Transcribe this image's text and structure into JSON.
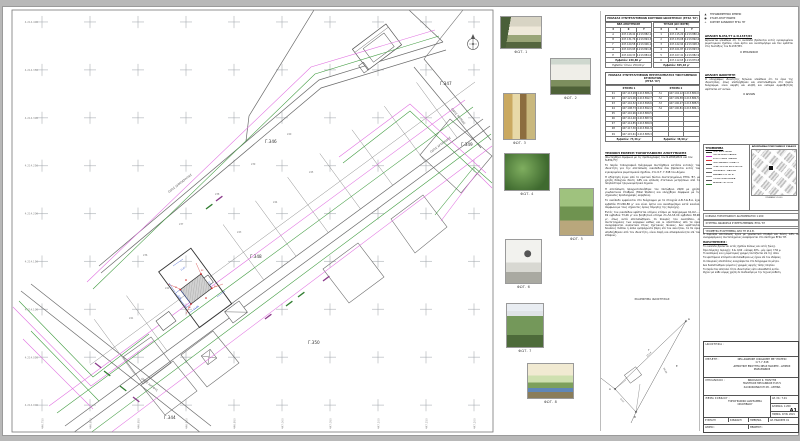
{
  "plan": {
    "northings": [
      "4.214.400",
      "4.214.350",
      "4.214.300",
      "4.214.250",
      "4.214.200",
      "4.214.150",
      "4.214.100",
      "4.214.050",
      "4.214.000"
    ],
    "eastings": [
      "446.750",
      "446.800",
      "446.850",
      "446.900",
      "446.950",
      "447.000",
      "447.050",
      "447.100",
      "447.150",
      "447.200"
    ],
    "blocks": {
      "g344": "Γ.344",
      "g346": "Γ.346",
      "g347": "Γ.347",
      "g348": "Γ.348",
      "g349": "Γ.349",
      "g350": "Γ.350"
    },
    "streets": {
      "a": "ΟΔΟΣ ΔΗΜΟΚΡΑΤΙΑΣ",
      "b": "ΟΔΟΣ ΑΡΤΕΜΙΔΟΣ",
      "c": "ΟΔΟΣ ΛΗΤΟΥΣ",
      "d": "ΟΔΟΣ ΝΗΡΕΩΣ"
    },
    "parcel_numbers": [
      "236",
      "237",
      "238",
      "239",
      "240",
      "241",
      "242",
      "243",
      "244",
      "245"
    ],
    "subject": {
      "corner_labels": [
        "Κ1",
        "Κ2",
        "Κ3",
        "Κ4"
      ],
      "dims": [
        "14,82",
        "9,75",
        "12,40",
        "8,96"
      ]
    },
    "colors": {
      "green": "#3f9b3f",
      "magenta": "#e06ee0",
      "purple": "#8b3a8b",
      "line": "#6b6b6b",
      "red": "#cc2222",
      "blue": "#3355cc"
    }
  },
  "photos": {
    "items": [
      {
        "caption": "ΦΩΤ. 1"
      },
      {
        "caption": "ΦΩΤ. 2"
      },
      {
        "caption": "ΦΩΤ. 3"
      },
      {
        "caption": "ΦΩΤ. 4"
      },
      {
        "caption": "ΦΩΤ. 5"
      },
      {
        "caption": "ΦΩΤ. 6"
      },
      {
        "caption": "ΦΩΤ. 7"
      },
      {
        "caption": "ΦΩΤ. 8"
      }
    ]
  },
  "tables": {
    "t1": {
      "title": "ΠΙΝΑΚΑΣ ΣΥΝΤΕΤΑΓΜΕΝΩΝ ΚΟΡΥΦΩΝ ΙΔΙΟΚΤΗΣΙΑΣ (ΕΓΣΑ '87)",
      "left_header": "ΝΕΑ ΑΠΟΤΥΠΩΣΗ",
      "right_header": "ΤΙΤΛΟΣ (ΩΣ ΙΣΧΥΕΙ)",
      "col_id": "Σ",
      "col_x": "Χ",
      "col_y": "Υ",
      "left_rows": [
        {
          "id": "Α",
          "x": "447.118,42",
          "y": "4.213.882,15"
        },
        {
          "id": "Β",
          "x": "447.131,76",
          "y": "4.213.894,30"
        },
        {
          "id": "Γ",
          "x": "447.120,58",
          "y": "4.213.906,12"
        },
        {
          "id": "Δ",
          "x": "447.103,95",
          "y": "4.213.891,84"
        },
        {
          "id": "Ε",
          "x": "447.109,33",
          "y": "4.213.884,07"
        }
      ],
      "right_rows": [
        {
          "id": "1",
          "x": "447.115,20",
          "y": "4.213.880,45"
        },
        {
          "id": "2",
          "x": "447.133,08",
          "y": "4.213.892,60"
        },
        {
          "id": "3",
          "x": "447.122,94",
          "y": "4.213.908,33"
        },
        {
          "id": "4",
          "x": "447.101,87",
          "y": "4.213.893,52"
        },
        {
          "id": "5",
          "x": "447.107,41",
          "y": "4.213.882,96"
        },
        {
          "id": "6",
          "x": "447.112,65",
          "y": "4.213.879,88"
        }
      ],
      "foot_left": "Εμβαδόν: 246,80 μ²",
      "foot_left2": "Εμβαδόν τίτλου: 250,00 μ²",
      "foot_right": "Εμβαδόν: 305,18 μ²"
    },
    "t2": {
      "title1": "ΠΙΝΑΚΑΣ ΣΥΝΤΕΤΑΓΜΕΝΩΝ ΠΕΡΙΓΡΑΜΜΑΤΟΣ ΥΦΙΣΤΑΜΕΝΩΝ ΚΤΙΣΜΑΤΩΝ",
      "title2": "(ΕΓΣΑ '87)",
      "gh_left": "ΚΤΙΣΜΑ 1",
      "gh_right": "ΚΤΙΣΜΑ 2",
      "rows": [
        {
          "lid": "Κ1",
          "lx": "447.113,28",
          "ly": "4.213.886,41",
          "rid": "Λ1",
          "rx": "447.104,12",
          "ry": "4.213.880,06"
        },
        {
          "lid": "Κ2",
          "lx": "447.121,06",
          "ly": "4.213.892,77",
          "rid": "Λ2",
          "rx": "447.109,58",
          "ry": "4.213.884,51"
        },
        {
          "lid": "Κ3",
          "lx": "447.116,52",
          "ly": "4.213.898,64",
          "rid": "Λ3",
          "rx": "447.106,27",
          "ry": "4.213.888,59"
        },
        {
          "lid": "Κ4",
          "lx": "447.108,73",
          "ly": "4.213.892,28",
          "rid": "Λ4",
          "rx": "447.100,81",
          "ry": "4.213.884,14"
        },
        {
          "lid": "Κ5",
          "lx": "447.110,96",
          "ly": "4.213.889,55",
          "rid": "",
          "rx": "",
          "ry": ""
        },
        {
          "lid": "Κ6",
          "lx": "447.112,40",
          "ly": "4.213.887,93",
          "rid": "",
          "rx": "",
          "ry": ""
        },
        {
          "lid": "Κ7",
          "lx": "447.114,85",
          "ly": "4.213.889,96",
          "rid": "",
          "rx": "",
          "ry": ""
        },
        {
          "lid": "Κ8",
          "lx": "447.117,30",
          "ly": "4.213.891,98",
          "rid": "",
          "rx": "",
          "ry": ""
        },
        {
          "lid": "Κ9",
          "lx": "447.115,61",
          "ly": "4.213.888,34",
          "rid": "",
          "rx": "",
          "ry": ""
        }
      ],
      "foot_left": "Εμβαδόν: 73,46 μ²",
      "foot_right": "Εμβαδόν: 38,90 μ²"
    }
  },
  "report": {
    "heading": "ΤΕΧΝΙΚΗ ΕΚΘΕΣΗ ΤΟΠΟΓΡΑΦΙΚΗΣ ΑΠΟΤΥΠΩΣΗΣ",
    "subheading": "(Συντάχθηκε σύμφωνα με τις προδιαγραφές του Ν.4030/2011 και του Ν.651/77)",
    "paragraphs": [
      "Το παρόν τοπογραφικό διάγραμμα συντάχθηκε κατόπιν εντολής του ιδιοκτήτη για την αποτύπωση οικοπέδου που βρίσκεται εντός του εγκεκριμένου ρυμοτομικού σχεδίου, στο Ο.Τ. Γ.348 του Δήμου.",
      "Η εξάρτηση έγινε από το κρατικό δίκτυο συντεταγμένων ΕΓΣΑ '87, με χρήση δίσυχνου δέκτη GPS και επίλυση στατικών μετρήσεων από τα πλησιέστερα τριγωνομετρικά σημεία.",
      "Η αποτύπωση πραγματοποιήθηκε τον Οκτώβριο 2020 με χρήση γεωδαιτικού σταθμού (Total Station) και ελέγχθηκε σύμφωνα με τις ισχύουσες προδιαγραφές ακριβείας.",
      "Το οικόπεδο εμφαίνεται στο διάγραμμα με τα στοιχεία Α-Β-Γ-Δ-Ε-Α, έχει εμβαδόν Ε=246,80 μ² και είναι άρτιο και οικοδομήσιμο κατά κανόνα, σύμφωνα με τους ισχύοντες όρους δόμησης της περιοχής.",
      "Εντός του οικοπέδου υφίσταται ισόγειο κτίσμα με περίγραμμα Κ1-Κ2-...-Κ9 εμβαδού 73,46 μ² και βοηθητικό κτίσμα Λ1-Λ2-Λ3-Λ4 εμβαδού 38,90 μ², όπως αυτά αποτυπώθηκαν. Οι πλευρές του οικοπέδου, οι συντεταγμένες των κορυφών καθώς και οι αποστάσεις από τα όρια αναγράφονται αναλυτικά στους σχετικούς πίνακες. Δεν υφίστανται δουλείες διόδου ή άλλα εμπράγματα βάρη επί του ακινήτου, τα δε όρια υποδείχθηκαν από τον ιδιοκτήτη, είναι σαφή και αδιαφιλονίκητα επί του εδάφους."
    ]
  },
  "sketch": {
    "title": "ΣΚΑΡΙΦΗΜΑ ΙΔΙΟΚΤΗΣΙΑΣ",
    "v1": "Δ",
    "v2": "Γ",
    "v3": "Ε",
    "v4": "Α",
    "v5": "Β",
    "d1": "25,14",
    "d2": "30,06",
    "d3": "9,12"
  },
  "right_col": {
    "symbols": [
      {
        "sym": "▲",
        "label": "ΤΡΙΓΩΝΟΜΕΤΡΙΚΟ ΣΗΜΕΙΟ"
      },
      {
        "sym": "●",
        "label": "ΣΤΑΣΗ ΑΠΟΤΥΠΩΣΗΣ"
      },
      {
        "sym": "+",
        "label": "ΚΟΡΥΦΗ ΚΑΝΝΑΒΟΥ ΕΓΣΑ '87"
      }
    ],
    "decl1": {
      "heading": "ΔΗΛΩΣΗ Ν.651/77 & Ν.1337/83",
      "text": "Δηλώνεται υπεύθυνα ότι το οικόπεδο βρίσκεται εντός εγκεκριμένου ρυμοτομικού σχεδίου, είναι άρτιο και οικοδομήσιμο και δεν εμπίπτει στις διατάξεις του Ν.1337/83.",
      "signer": "Ο ΜΗΧΑΝΙΚΟΣ"
    },
    "decl2": {
      "heading": "ΔΗΛΩΣΗ ΙΔΙΟΚΤΗΤΗ",
      "text": "Ο υπογράφων ιδιοκτήτης δηλώνει υπεύθυνα ότι τα όρια της ιδιοκτησίας, όπως υποδείχθηκαν και αποτυπώθηκαν στο παρόν διάγραμμα, είναι ακριβή και αληθή και ουδεμία αμφισβήτηση υφίσταται επ' αυτών.",
      "signer": "Ο ΔΗΛΩΝ"
    },
    "legend": {
      "title": "ΥΠΟΜΝΗΜΑ",
      "items": [
        {
          "label": "ΟΡΙΟ ΙΔΙΟΚΤΗΣΙΑΣ",
          "color": "#333333"
        },
        {
          "label": "ΟΙΚΟΔΟΜΙΚΗ ΓΡΑΜΜΗ",
          "color": "#cc33cc"
        },
        {
          "label": "ΡΥΜΟΤΟΜΙΚΗ ΓΡΑΜΜΗ",
          "color": "#d63333"
        },
        {
          "label": "ΠΕΡΙΓΡΑΜΜΑ ΚΤΙΣΜΑΤΟΣ",
          "color": "#444444"
        },
        {
          "label": "ΟΡΙΑ ΟΜΟΡΩΝ ΙΔΙΟΚΤΗΣΙΩΝ",
          "color": "#888888"
        },
        {
          "label": "ΠΕΡΙΦΡΑΞΗ - ΜΑΝΤΡΑ",
          "color": "#666666"
        },
        {
          "label": "ΚΑΝΝΑΒΟΣ ΕΓΣΑ '87",
          "color": "#999999"
        },
        {
          "label": "ΥΨΟΜΕΤΡΙΚΑ ΣΗΜΕΙΑ",
          "color": "#555555"
        },
        {
          "label": "ΔΕΝΔΡΑ - ΦΥΤΕΥΣΗ",
          "color": "#2f7d2f"
        }
      ]
    },
    "map": {
      "title": "ΑΠΟΣΠΑΣΜΑ ΡΥΜΟΤΟΜΙΚΟΥ ΣΧΕΔΙΟΥ",
      "scale": "ΚΛΙΜΑΚΑ 1:1000"
    },
    "scale_rows": [
      "ΚΛΙΜΑΚΑ ΤΟΠΟΓΡΑΦΙΚΟΥ ΔΙΑΓΡΑΜΜΑΤΟΣ 1:200",
      "ΣΥΣΤΗΜΑ ΑΝΑΦΟΡΑΣ ΣΥΝΤΕΤΑΓΜΕΝΩΝ: ΕΓΣΑ '87",
      "ΥΨΟΜΕΤΡΑ ΕΞΑΡΤΗΜΕΝΑ ΑΠΟ ΤΗ Μ.Σ.Θ."
    ],
    "notes": {
      "intro": "Η παρούσα αποτύπωση έγινε με γεωδαιτικό σταθμό και δέκτη GPS. Οι αναγραφόμενες συντεταγμένες αναφέρονται στο σύστημα ΕΓΣΑ '87.",
      "heading": "ΠΑΡΑΤΗΡΗΣΕΙΣ :",
      "items": [
        "Το οικόπεδο βρίσκεται εντός σχεδίου πόλεως και εντός ζώνης.",
        "Όροι δόμησης περιοχής: Σ.Δ. 0,60 - κάλυψη 40% - μέγ. ύψος 7,50 μ.",
        "Η οικοδομική και η ρυμοτομική γραμμή ταυτίζονται επί της οδού.",
        "Τα υφιστάμενα κτίσματα αποτυπώθηκαν ως έχουν επί του εδάφους.",
        "Οι πλευρικές αποστάσεις αναγράφονται στο διάγραμμα σε μέτρα.",
        "Δεν διαπιστώθηκαν ρέματα ή γραμμές υψηλής τάσης πλησίον.",
        "Το παρόν δεν αποτελεί τίτλο ιδιοκτησίας ούτε υποκαθιστά αυτόν.",
        "Ισχύει για κάθε νόμιμη χρήση σε συνδυασμό με την τεχνική έκθεση."
      ]
    },
    "titleblock": {
      "r1_label": "ΙΔΙΟΚΤΗΣΙΑ :",
      "r2_label": "ΜΕΛΕΤΗ :",
      "r2_lines": [
        "ΝΕΑ ΔΙΩΡΟΦΗ ΟΙΚΟΔΟΜΗ ΜΕ ΥΠΟΓΕΙΟ",
        "Ο.Τ. Γ.348",
        "ΔΗΜΟΤΙΚΗ ΕΝΟΤΗΤΑ ΝΕΑΣ ΜΑΚΡΗΣ - ΔΗΜΟΣ ΜΑΡΑΘΩΝΟΣ"
      ],
      "r3_label": "ΜΗΧΑΝΙΚΟΣ :",
      "r3_lines": [
        "ΝΙΚΟΛΑΟΣ Κ. ΠΟΛΙΤΗΣ",
        "ΠΟΛΙΤΙΚΟΣ ΜΗΧΑΝΙΚΟΣ Ε.Μ.Π.",
        "ΧΑΛΚΟΚΟΝΔΥΛΗ 28 - ΑΘΗΝΑ"
      ],
      "r4_label": "ΘΕΜΑ ΣΧΕΔΙΟΥ :",
      "r4_lines": [
        "ΤΟΠΟΓΡΑΦΙΚΟ ΔΙΑΓΡΑΜΜΑ",
        "ΟΙΚΟΠΕΔΟΥ"
      ],
      "arsx_label": "ΑΡ. ΣΧ.:",
      "arsx": "Τ-01",
      "klimaka_label": "ΚΛΙΜΑΚΑ:",
      "klimaka": "1:200",
      "sheet": "Α1",
      "date_label": "ΗΜ/ΝΙΑ:",
      "date": "ΙΟΥΝ. 2021",
      "r5_cells": [
        "ΣΥΝΤΑΞΗ",
        "ΣΧΕΔΙΑΣΗ",
        "ΗΜΕΡ/ΝΙΑ",
        "ΑΡ. ΕΚΔΟΣΗΣ 01"
      ],
      "r6_cells": [
        "ΑΡΧΕΙΟ :",
        "ΘΕΩΡΗΣΗ :"
      ]
    }
  }
}
